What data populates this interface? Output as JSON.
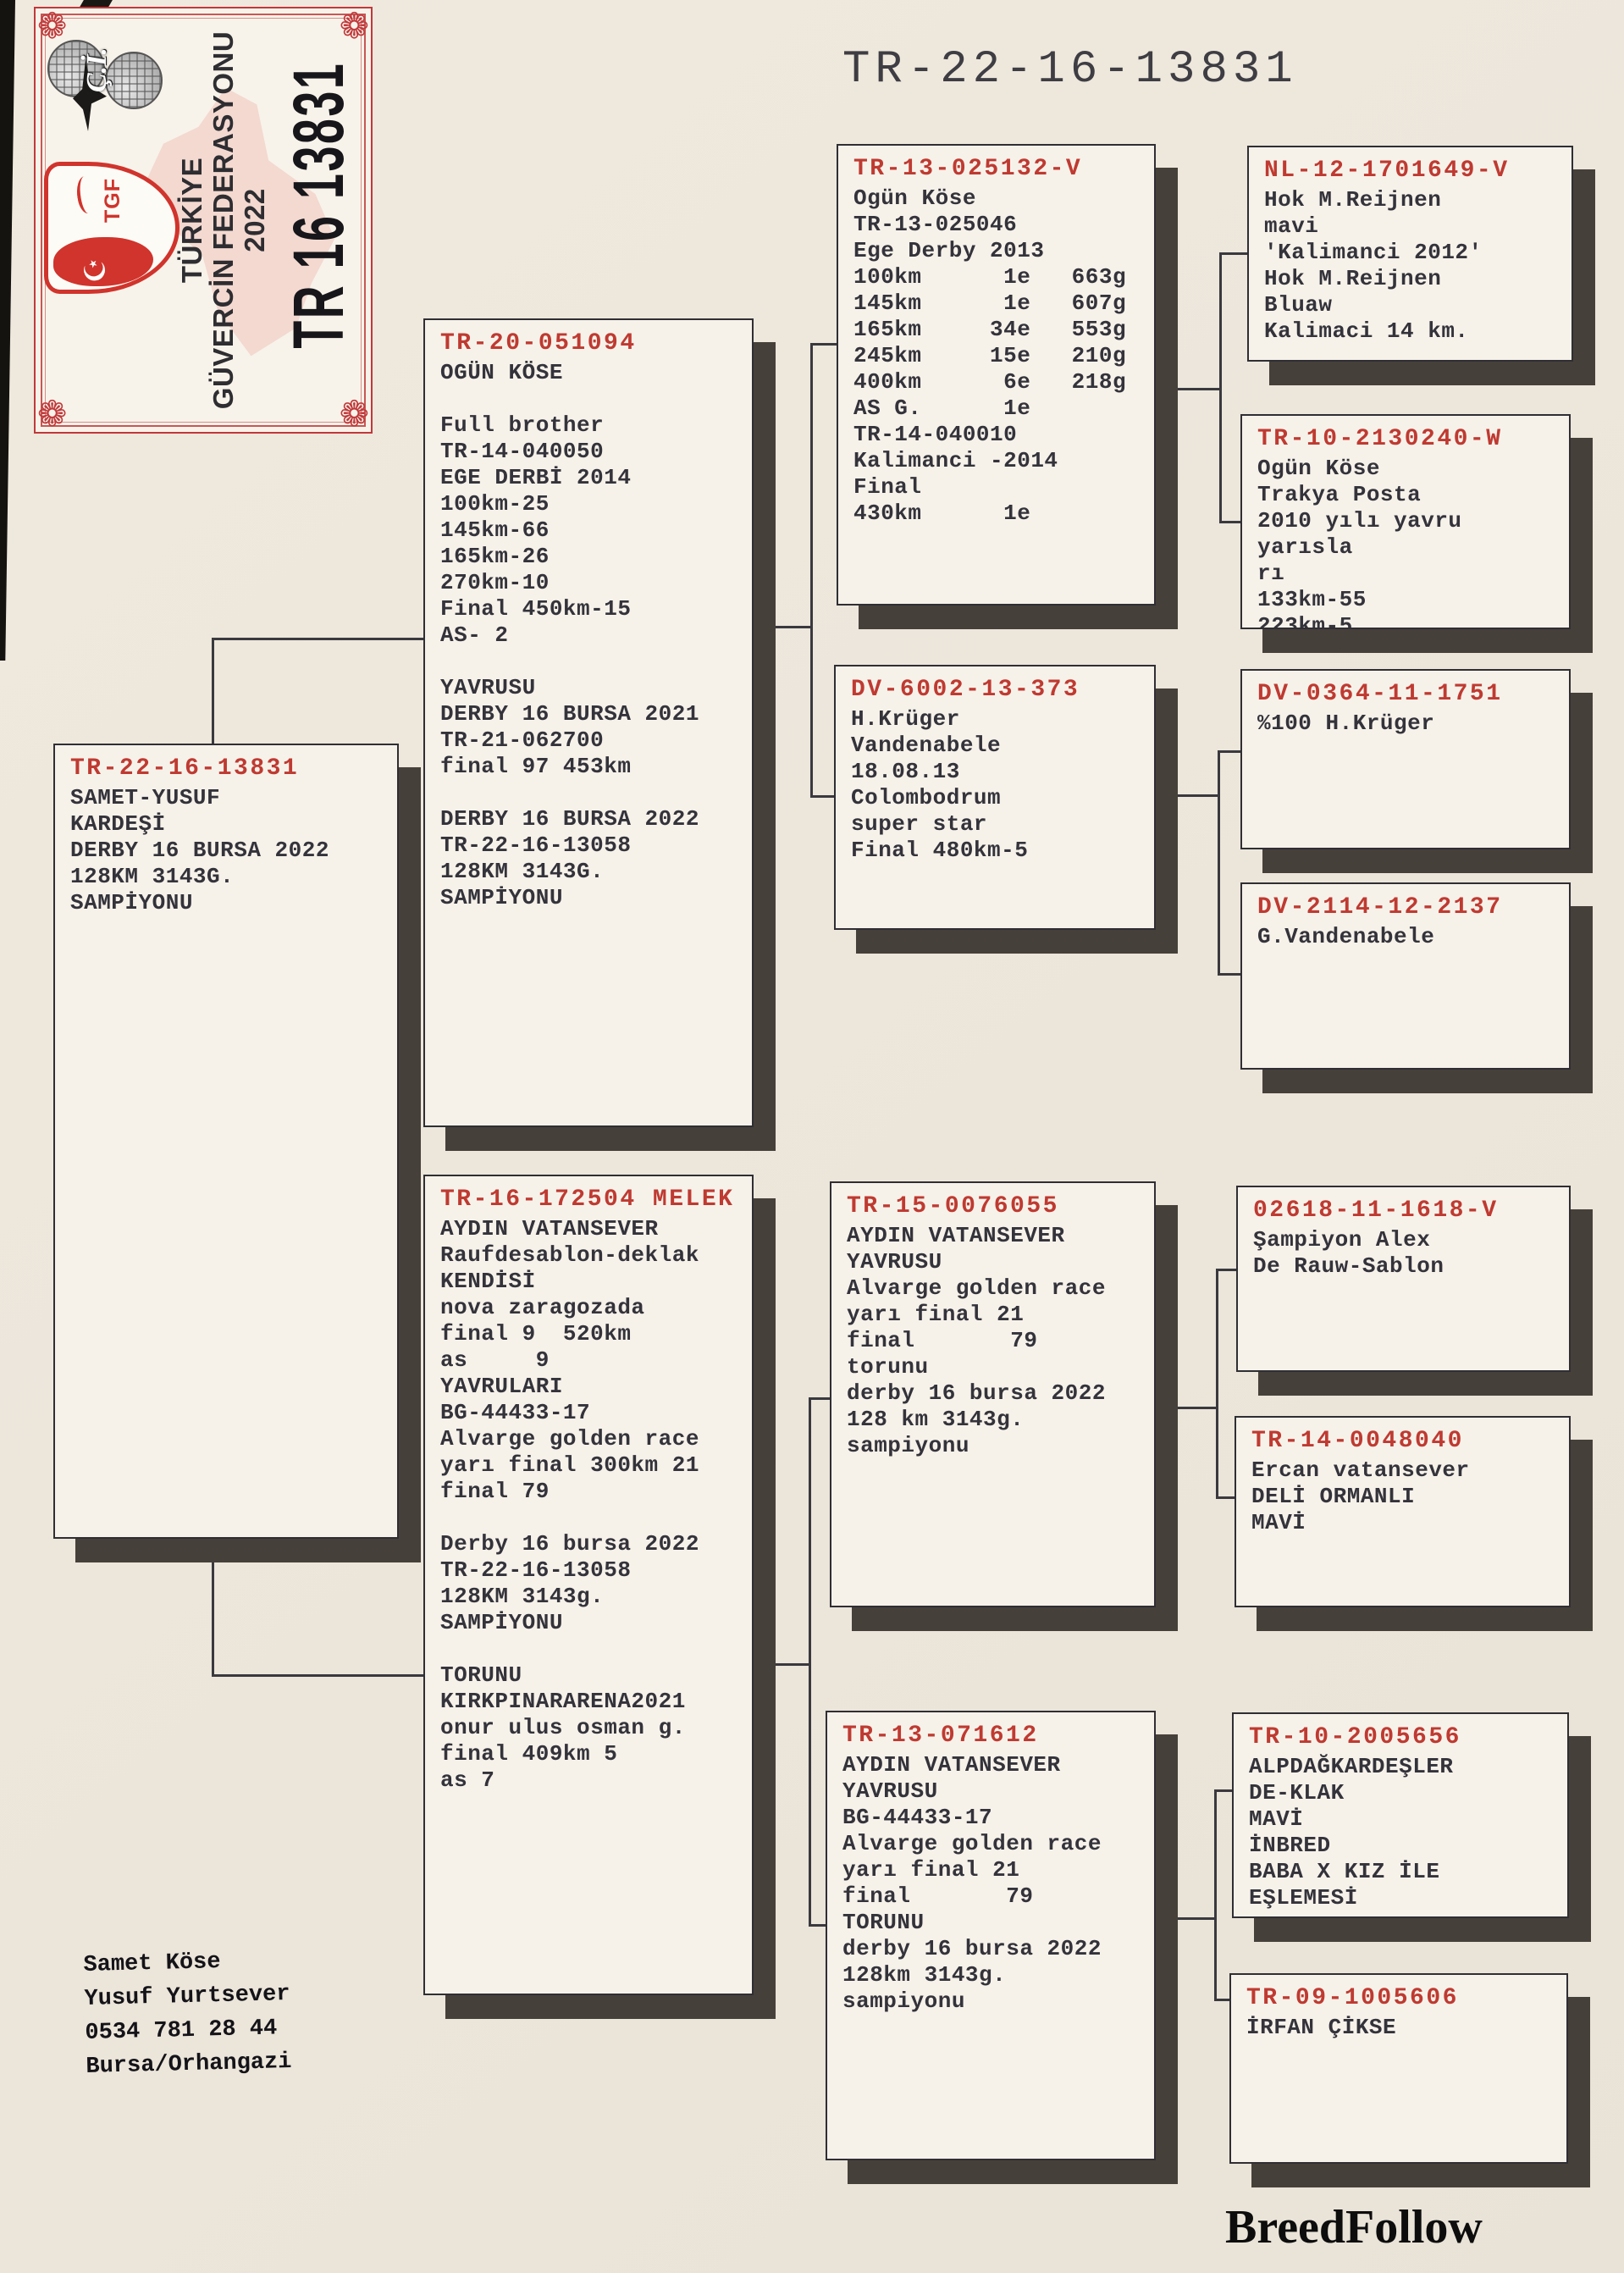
{
  "title": "TR-22-16-13831",
  "certificate": {
    "federation_line1": "TÜRKİYE",
    "federation_line2": "GÜVERCİN FEDERASYONU",
    "year": "2022",
    "ring_number": "TR 16 13831",
    "crest_text": "TGF",
    "crest_moon": "☪",
    "monogram": "Ç.İ.",
    "corner_ornament": "❁"
  },
  "boxes": [
    {
      "ring": "TR-22-16-13831",
      "body": "SAMET-YUSUF\nKARDEŞİ\nDERBY 16 BURSA 2022\n128KM 3143G.\nSAMPİYONU"
    },
    {
      "ring": "TR-20-051094",
      "body": "OGÜN KÖSE\n\nFull brother\nTR-14-040050\nEGE DERBİ 2014\n100km-25\n145km-66\n165km-26\n270km-10\nFinal 450km-15\nAS- 2\n\nYAVRUSU\nDERBY 16 BURSA 2021\nTR-21-062700\nfinal 97 453km\n\nDERBY 16 BURSA 2022\nTR-22-16-13058\n128KM 3143G.\nSAMPİYONU"
    },
    {
      "ring": "TR-16-172504 MELEK",
      "body": "AYDIN VATANSEVER\nRaufdesablon-deklak\nKENDİSİ\nnova zaragozada\nfinal 9  520km\nas     9\nYAVRULARI\nBG-44433-17\nAlvarge golden race\nyarı final 300km 21\nfinal 79\n\nDerby 16 bursa 2022\nTR-22-16-13058\n128KM 3143g.\nSAMPİYONU\n\nTORUNU\nKIRKPINARARENA2021\nonur ulus osman g.\nfinal 409km 5\nas 7"
    },
    {
      "ring": "TR-13-025132-V",
      "body": "Ogün Köse\nTR-13-025046\nEge Derby 2013\n100km      1e   663g\n145km      1e   607g\n165km     34e   553g\n245km     15e   210g\n400km      6e   218g\nAS G.      1e\nTR-14-040010\nKalimanci -2014 Final\n430km      1e"
    },
    {
      "ring": "DV-6002-13-373",
      "body": "H.Krüger\nVandenabele\n18.08.13\nColombodrum\nsuper star\nFinal 480km-5"
    },
    {
      "ring": "TR-15-0076055",
      "body": "AYDIN VATANSEVER\nYAVRUSU\nAlvarge golden race\nyarı final 21\nfinal       79\ntorunu\nderby 16 bursa 2022\n128 km 3143g.\nsampiyonu"
    },
    {
      "ring": "TR-13-071612",
      "body": "AYDIN VATANSEVER\nYAVRUSU\nBG-44433-17\nAlvarge golden race\nyarı final 21\nfinal       79\nTORUNU\nderby 16 bursa 2022\n128km 3143g.\nsampiyonu"
    },
    {
      "ring": "NL-12-1701649-V",
      "body": "Hok M.Reijnen\nmavi\n'Kalimanci 2012'\nHok M.Reijnen\nBluaw\nKalimaci 14 km."
    },
    {
      "ring": "TR-10-2130240-W",
      "body": "Ogün Köse\nTrakya Posta\n2010 yılı yavru yarısla\nrı\n133km-55\n223km-5"
    },
    {
      "ring": "DV-0364-11-1751",
      "body": "%100 H.Krüger"
    },
    {
      "ring": "DV-2114-12-2137",
      "body": "G.Vandenabele"
    },
    {
      "ring": "02618-11-1618-V",
      "body": "Şampiyon Alex\nDe Rauw-Sablon"
    },
    {
      "ring": "TR-14-0048040",
      "body": "Ercan vatansever\nDELİ ORMANLI\nMAVİ"
    },
    {
      "ring": "TR-10-2005656",
      "body": "ALPDAĞKARDEŞLER\nDE-KLAK\nMAVİ\nİNBRED\nBABA X KIZ İLE\nEŞLEMESİ"
    },
    {
      "ring": "TR-09-1005606",
      "body": "İRFAN ÇİKSE"
    }
  ],
  "owner": {
    "lines": "Samet Köse\nYusuf Yurtsever\n0534 781 28 44\nBursa/Orhangazi"
  },
  "brand": "BreedFollow",
  "colors": {
    "accent_red": "#bf3a31",
    "ink": "#34333b",
    "line": "#3a393f",
    "shadow": "#46403a",
    "page_bg": "#ece6db",
    "card_bg": "#f6f2ea"
  }
}
